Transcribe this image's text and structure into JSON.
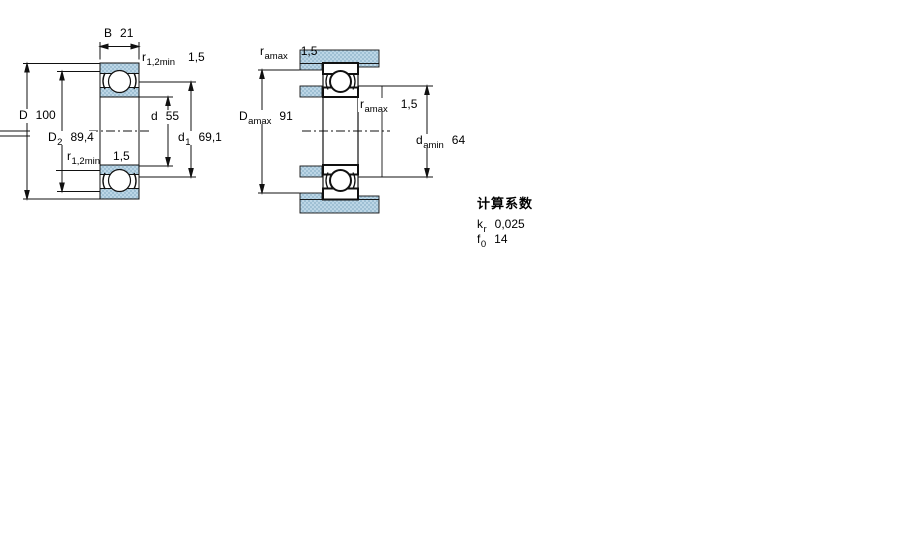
{
  "figure_type": "bearing-dimension-drawing",
  "colors": {
    "section_fill_light": "#bcd6e6",
    "section_fill_dark": "#9fc0d4",
    "line": "#111111",
    "background": "#ffffff"
  },
  "left_view": {
    "dims": {
      "B": {
        "label": "B",
        "value": "21"
      },
      "r12_top": {
        "label": "r",
        "sub": "1,2min",
        "value": "1,5"
      },
      "D": {
        "label": "D",
        "value": "100"
      },
      "D2": {
        "label": "D",
        "sub": "2",
        "value": "89,4"
      },
      "r12_bottom": {
        "label": "r",
        "sub": "1,2min",
        "value": "1,5"
      },
      "d": {
        "label": "d",
        "value": "55"
      },
      "d1": {
        "label": "d",
        "sub": "1",
        "value": "69,1"
      }
    }
  },
  "right_view": {
    "dims": {
      "ra_top": {
        "label": "r",
        "sub": "amax",
        "value": "1,5"
      },
      "Da": {
        "label": "D",
        "sub": "amax",
        "value": "91"
      },
      "ra_mid": {
        "label": "r",
        "sub": "amax",
        "value": "1,5"
      },
      "da": {
        "label": "d",
        "sub": "amin",
        "value": "64"
      }
    }
  },
  "calculation_factors": {
    "heading": "计算系数",
    "rows": [
      {
        "label": "k",
        "sub": "r",
        "value": "0,025"
      },
      {
        "label": "f",
        "sub": "0",
        "value": "14"
      }
    ]
  }
}
